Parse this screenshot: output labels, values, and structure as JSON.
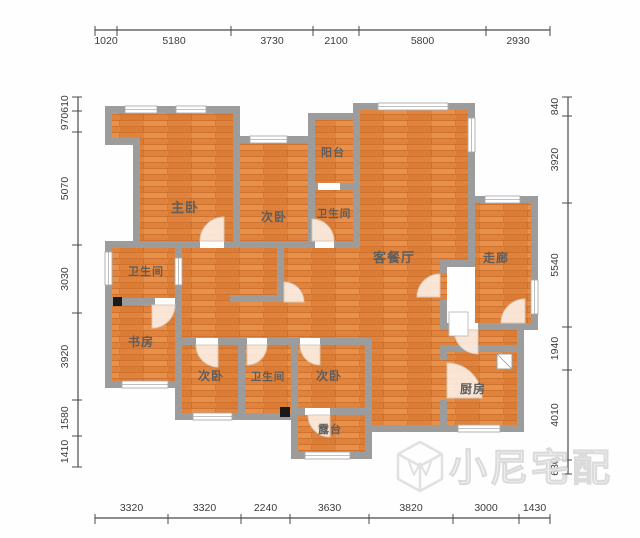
{
  "plan_title": "apartment-floor-plan",
  "dimensions": {
    "unit": "mm",
    "top": [
      "1020",
      "5180",
      "3730",
      "2100",
      "5800",
      "2930"
    ],
    "bottom": [
      "3320",
      "3320",
      "2240",
      "3630",
      "3820",
      "3000",
      "1430"
    ],
    "left": [
      "610",
      "970",
      "5070",
      "3030",
      "3920",
      "1580",
      "1410"
    ],
    "right": [
      "840",
      "3920",
      "5540",
      "1940",
      "4010",
      "630"
    ]
  },
  "rooms": [
    {
      "id": "master-bedroom",
      "label": "主卧"
    },
    {
      "id": "bedroom-top",
      "label": "次卧"
    },
    {
      "id": "balcony",
      "label": "阳台"
    },
    {
      "id": "bathroom-top",
      "label": "卫生间"
    },
    {
      "id": "living-dining",
      "label": "客餐厅"
    },
    {
      "id": "corridor",
      "label": "走廊"
    },
    {
      "id": "bathroom-left",
      "label": "卫生间"
    },
    {
      "id": "study",
      "label": "书房"
    },
    {
      "id": "bedroom-bottom-left",
      "label": "次卧"
    },
    {
      "id": "bathroom-bottom",
      "label": "卫生间"
    },
    {
      "id": "bedroom-bottom-mid",
      "label": "次卧"
    },
    {
      "id": "terrace",
      "label": "露台"
    },
    {
      "id": "kitchen",
      "label": "厨房"
    }
  ],
  "watermark": {
    "text": "小尼宅配",
    "logo": "cube-logo"
  },
  "colors": {
    "floor_base": "#e0843d",
    "floor_light": "#e8914a",
    "floor_dark": "#db7c34",
    "plank_line": "#c06322",
    "wall": "#9c9c9c",
    "room_label": "#5d5d5d",
    "dim_text": "#3c3c3c",
    "dim_line": "#4a4a4a",
    "window_fill": "#ffffff",
    "window_edge": "#ababab",
    "door_fill": "#fdf3ea",
    "door_edge": "#d9c9b8",
    "pillar": "#1a1a1a",
    "watermark": "#dedede"
  }
}
